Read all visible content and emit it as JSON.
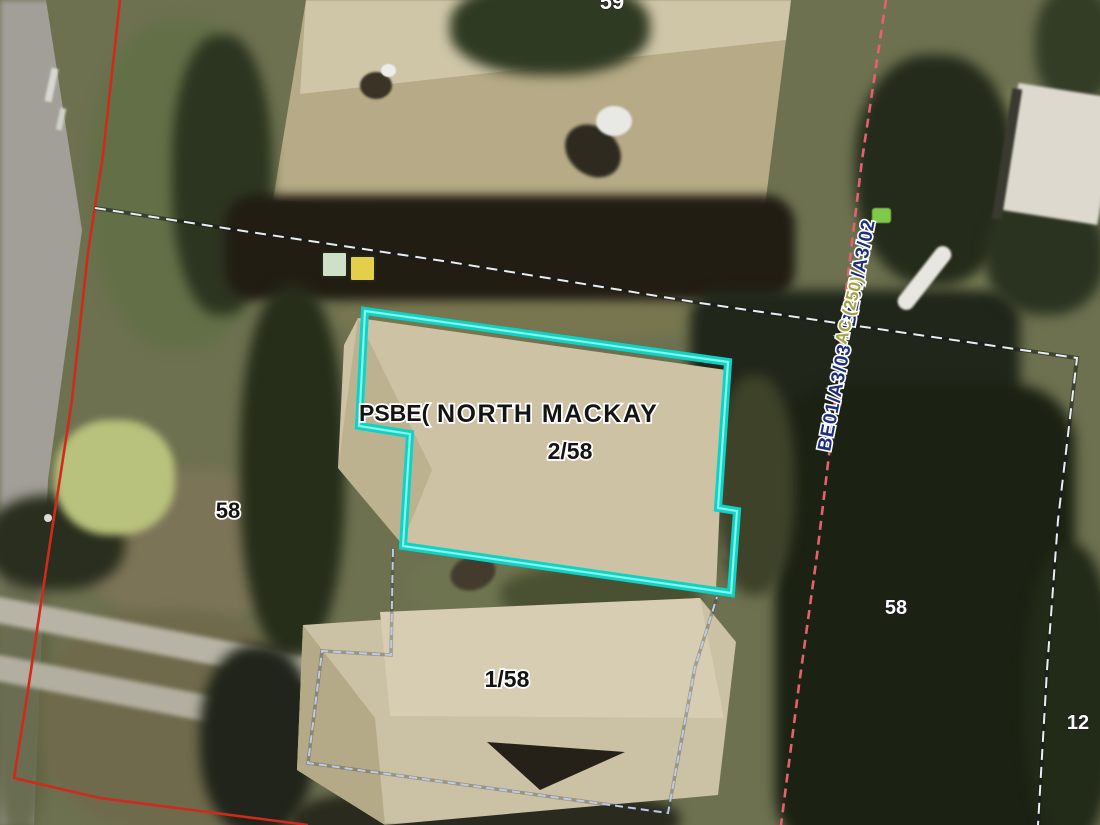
{
  "map": {
    "type": "cadastral-aerial-overlay",
    "labels": {
      "suburb": "NORTH MACKAY",
      "parcel_prefix": "PSBE(",
      "unit_upper": "2/58",
      "unit_lower": "1/58",
      "lot_left": "58",
      "lot_right": "58",
      "lot_adjacent": "12",
      "lot_top_partial": "59",
      "survey_ref": "BE01/A3/03 - BE01/A3/02",
      "area_code": "AC (250)"
    },
    "colors": {
      "highlight_cyan": "#0fd2c6",
      "highlight_cyan_inner": "#86f4e9",
      "boundary_red": "#cf2a1b",
      "boundary_pink": "#e4616e",
      "cadastre_white": "#e9eef5",
      "lot_line_blue": "#bfcbe4",
      "label_black": "#141414",
      "label_white": "#ffffff",
      "survey_navy": "#1d2f7c",
      "area_olive": "#a2a343"
    }
  }
}
